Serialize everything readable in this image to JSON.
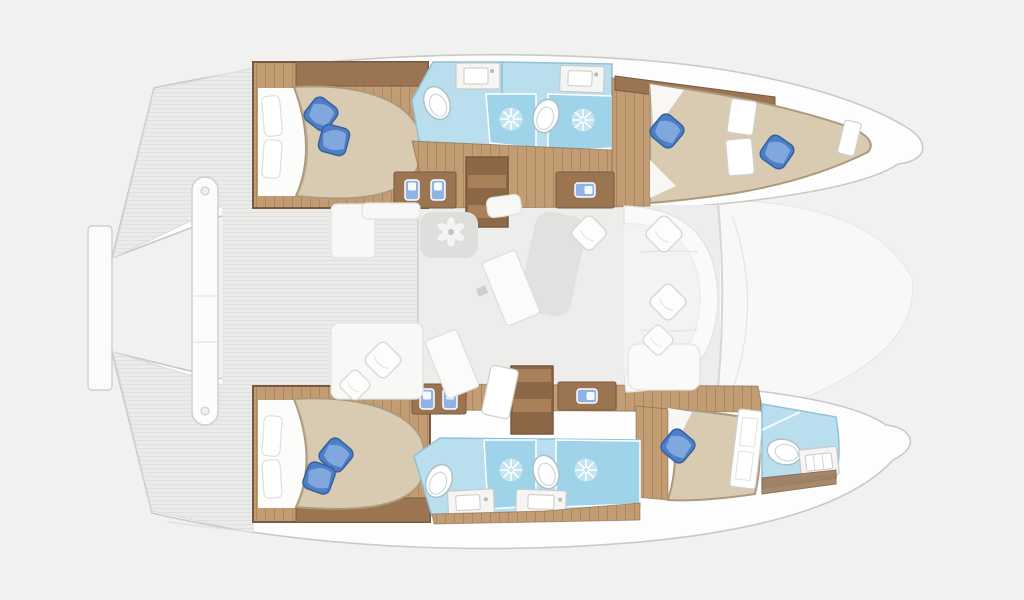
{
  "meta": {
    "title": "Catamaran yacht floor plan - top view",
    "background": "#f1f1f0"
  },
  "palette": {
    "background": "#f1f1f0",
    "hull_white": "#fdfdfd",
    "hull_stroke": "#c9c9c7",
    "deck_stripe": "#ebebea",
    "deck_stripe_line": "#e0e0df",
    "wood_floor": "#c29c73",
    "wood_floor_line": "#ad8660",
    "wood_dark": "#9b7452",
    "wood_edge": "#7a5a3e",
    "stair_dark": "#8d6847",
    "stair_light": "#aa8058",
    "bed_beige": "#d9cbb1",
    "bed_beige_edge": "#ab9a7e",
    "sheet_white": "#fcfcfb",
    "pillow_blue": "#4d7ec6",
    "pillow_blue_dark": "#35619f",
    "pillow_blue_light": "#8fb3e3",
    "bath_blue": "#b9dfee",
    "bath_blue_edge": "#8fc2d8",
    "shower_blue": "#9ed3e9",
    "fixture_white": "#ffffff",
    "fixture_stroke": "#aebfc7",
    "counter_white": "#f5f5f3",
    "counter_stroke": "#c9c9c7",
    "salon_floor": "#ededec",
    "furniture_gray": "#dededd",
    "sofa_white": "#fafaf9",
    "sofa_stroke": "#e2e2e0",
    "wall_line": "#d6d6d4"
  },
  "vessel": {
    "type": "catamaran",
    "orientation": "bows-right",
    "upper_hull": {
      "aft_cabin": {
        "bed": "island-double",
        "blue_pillows": 2,
        "white_pillows": 2,
        "wardrobe": true
      },
      "aft_bathroom": {
        "toilet": true,
        "sink": true,
        "shower": true
      },
      "mid_bathroom": {
        "toilet": true,
        "sink": true,
        "shower": true
      },
      "companionway_steps": 4,
      "sideboards": 2,
      "forward_cabin": {
        "berths": 2,
        "blue_pillows": 2
      }
    },
    "lower_hull": {
      "aft_cabin": {
        "bed": "island-double",
        "blue_pillows": 2,
        "white_pillows": 2,
        "wardrobe": true
      },
      "aft_bathroom": {
        "toilet": true,
        "sink": true,
        "shower": true
      },
      "mid_bathroom": {
        "toilet": true,
        "sink": true,
        "shower": true
      },
      "companionway_steps": 4,
      "sideboards": 2,
      "forward_cabin": {
        "berths": 1,
        "blue_pillows": 1
      },
      "bow_bathroom": {
        "toilet": true,
        "sink": true
      }
    },
    "salon": {
      "tables": 2,
      "chaise_lounge": 1,
      "sofa": 1,
      "white_cushions": 4,
      "fan": 1
    },
    "cockpit": {
      "bench": 1,
      "sofa": 1,
      "white_cushions": 2
    },
    "aft_platform": {
      "beam": true,
      "platform": true
    }
  }
}
